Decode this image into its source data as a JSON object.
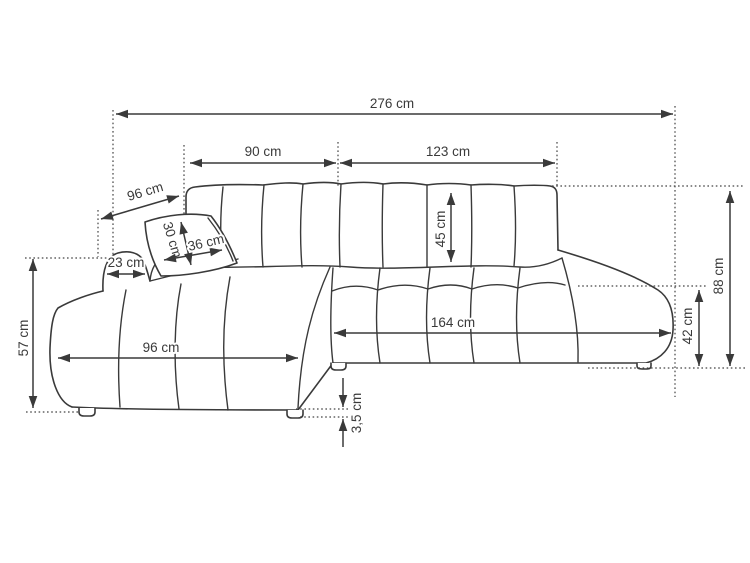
{
  "diagram": {
    "type": "furniture dimension drawing",
    "subject": "corner sofa with chaise longue and pillow",
    "unit": "cm",
    "background_color": "#ffffff",
    "line_color": "#3a3a3a",
    "dimensions": {
      "total_width": "276 cm",
      "back_section_left": "90 cm",
      "back_section_right": "123 cm",
      "chaise_back_depth": "96 cm",
      "backrest_cushion_height": "45 cm",
      "pillow_height": "30 cm",
      "pillow_width": "36 cm",
      "armrest_width": "23 cm",
      "chaise_side_height": "57 cm",
      "chaise_front_length": "96 cm",
      "seat_front_length": "164 cm",
      "seat_height": "42 cm",
      "total_height": "88 cm",
      "legs_height": "3,5 cm"
    }
  }
}
